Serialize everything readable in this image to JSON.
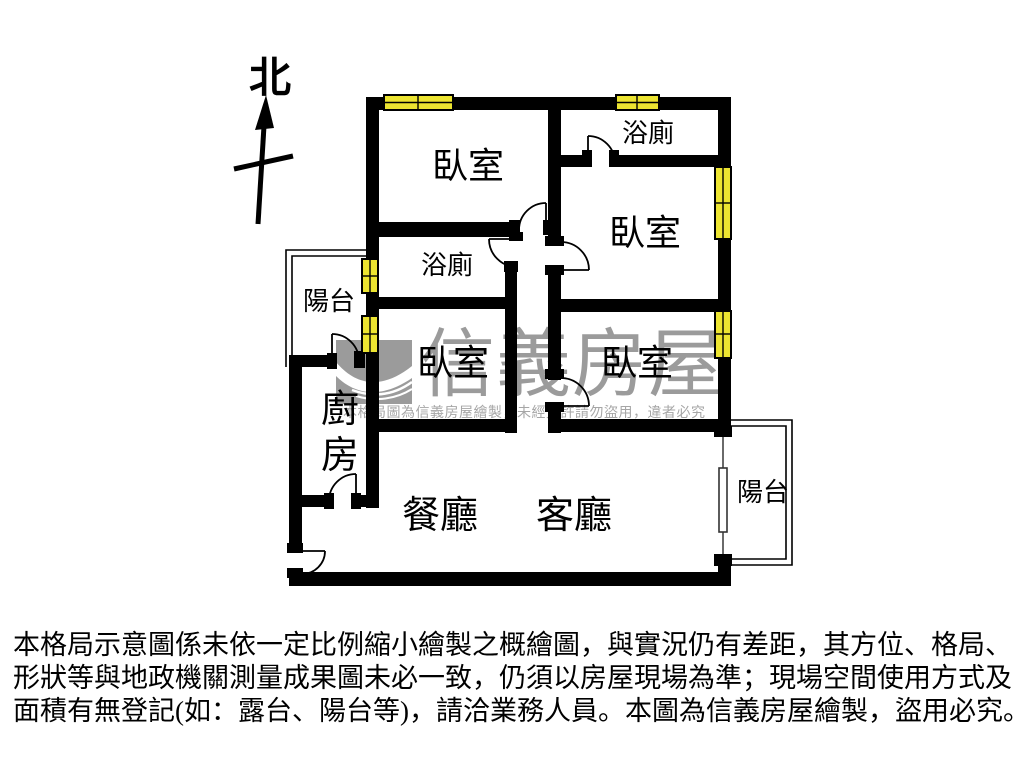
{
  "compass": {
    "north_label": "北"
  },
  "plan": {
    "rooms": {
      "bedroom_top_left": "臥室",
      "bathroom_top": "浴廁",
      "bedroom_right_upper": "臥室",
      "bathroom_middle": "浴廁",
      "bedroom_middle": "臥室",
      "bedroom_right_lower": "臥室",
      "balcony_left": "陽台",
      "kitchen": "廚房",
      "dining": "餐廳",
      "living": "客廳",
      "balcony_right": "陽台"
    },
    "colors": {
      "wall": "#000000",
      "window": "#ece431",
      "watermark_gray": "#9b9b9b",
      "notice_gray": "#a6a6a6",
      "background": "#ffffff"
    },
    "icons": {
      "windows": "yellow-window-symbol",
      "doors": "door-swing-arc",
      "sliding_door": "sliding-door-symbol",
      "compass": "north-arrow",
      "logo": "sinyi-swoosh-logo"
    }
  },
  "watermark": {
    "brand": "信義房屋",
    "notice": "本格局圖為信義房屋繪製，未經允許請勿盜用，違者必究"
  },
  "disclaimer": {
    "line1": "本格局示意圖係未依一定比例縮小繪製之概繪圖，與實況仍有差距，其方位、格局、",
    "line2": "形狀等與地政機關測量成果圖未必一致，仍須以房屋現場為準；現場空間使用方式及",
    "line3": "面積有無登記(如：露台、陽台等)，請洽業務人員。本圖為信義房屋繪製，盜用必究。"
  }
}
